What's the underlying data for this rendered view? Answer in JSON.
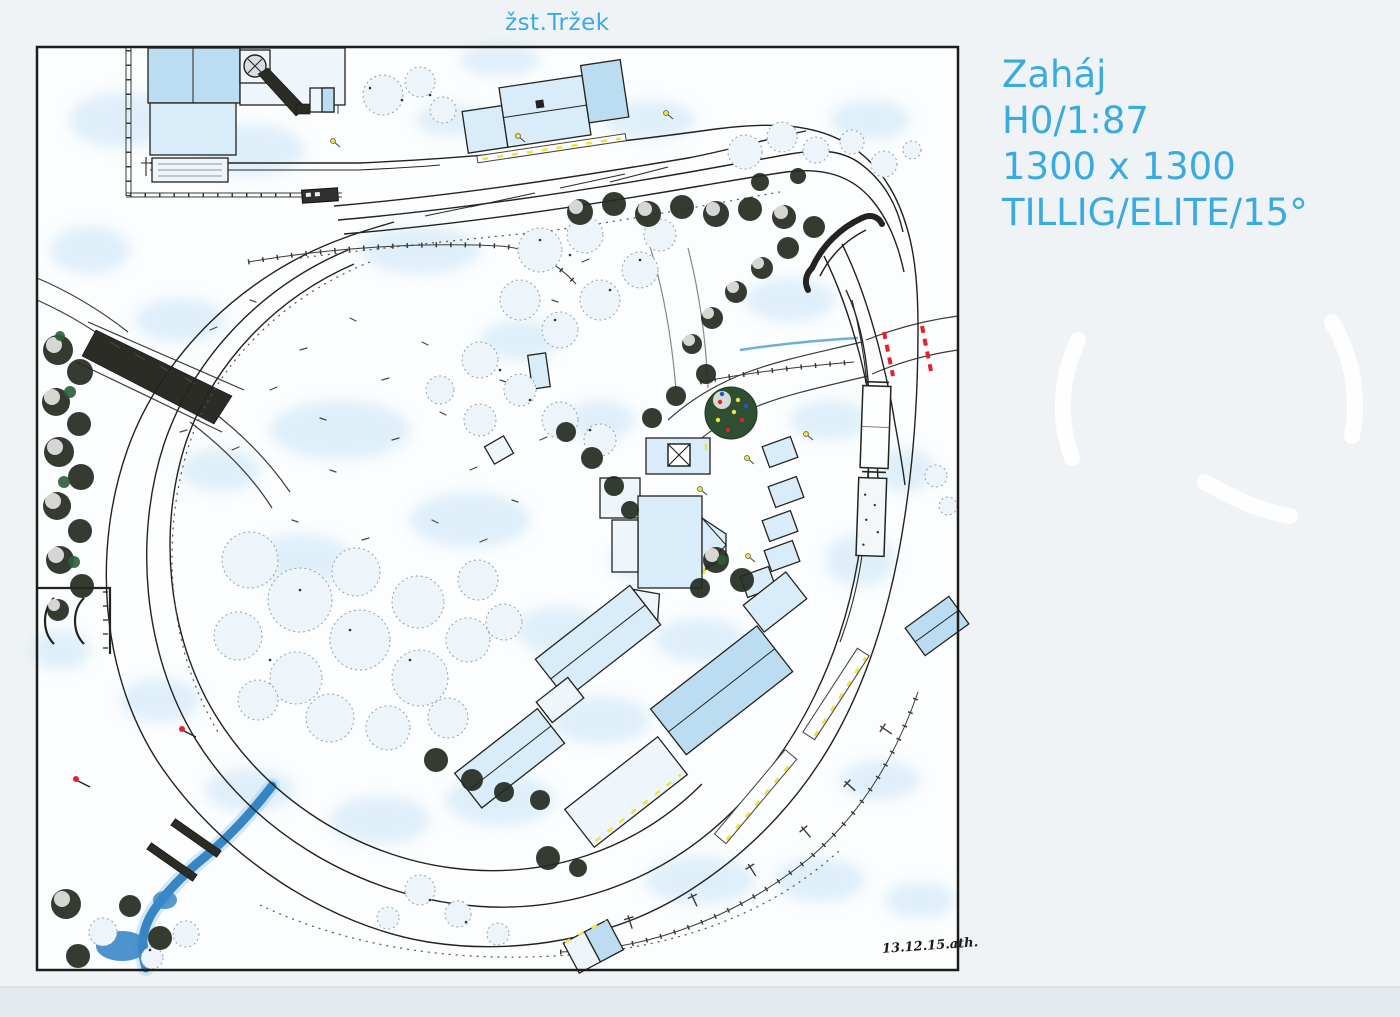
{
  "page": {
    "background": "#eff3f5",
    "bottom_band": "#e2eaf0"
  },
  "header": {
    "station_label": "žst.Tržek"
  },
  "info_panel": {
    "lines": [
      "Zaháj",
      "H0/1:87",
      "1300 x 1300",
      "TILLIG/ELITE/15°"
    ]
  },
  "plan": {
    "signature": "13.12.15.ath."
  },
  "colors": {
    "page_bg": "#eff3f5",
    "accent": "#3aabdf",
    "ink": "#22221f",
    "paper": "#fbfdfe",
    "roof_blue": "#bcdcf2",
    "snow_shadow": "#c9e4f6",
    "water_blue": "#2e7fc0",
    "signal_red": "#e8202a",
    "accent_yellow": "#f2e23a",
    "tree_green": "#2e5d36"
  }
}
